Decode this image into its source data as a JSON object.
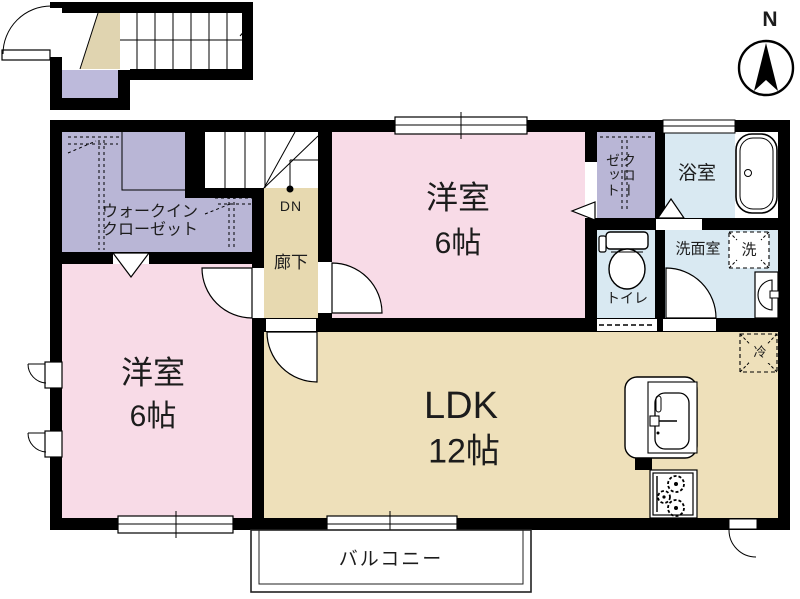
{
  "compass": {
    "north_label": "N"
  },
  "rooms": {
    "walk_in_closet": {
      "label_line1": "ウォークイン",
      "label_line2": "クローゼット"
    },
    "hallway": {
      "label": "廊下"
    },
    "stairs": {
      "down_label": "DN"
    },
    "bedroom_top": {
      "label": "洋室",
      "size": "6帖"
    },
    "closet": {
      "label": "クローゼット"
    },
    "bathroom": {
      "label": "浴室"
    },
    "toilet": {
      "label": "トイレ"
    },
    "washroom": {
      "label": "洗面室"
    },
    "bedroom_left": {
      "label": "洋室",
      "size": "6帖"
    },
    "ldk": {
      "label": "LDK",
      "size": "12帖"
    },
    "balcony": {
      "label": "バルコニー"
    }
  },
  "fixtures": {
    "washing_machine_label": "洗",
    "refrigerator_label": "冷"
  },
  "colors": {
    "room_pink": "#f8dbe7",
    "room_lavender": "#b9b6d6",
    "room_tan": "#eee0ba",
    "room_blue": "#d9e9f2",
    "wall": "#000000"
  }
}
